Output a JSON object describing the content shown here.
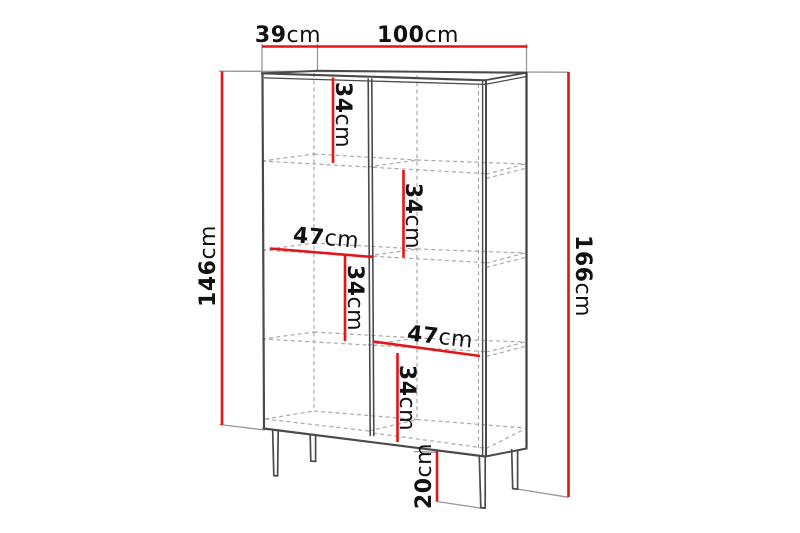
{
  "diagram": {
    "kind": "furniture-dimension-drawing",
    "subject": "two-door display cabinet with legs and interior shelves"
  },
  "colors": {
    "dimension_red": "#e61319",
    "carcass_line": "#4a4a4a",
    "back_edge_line": "#3f3f3f",
    "hidden_dashed_line": "#a8a8a8",
    "extension_line": "#979797",
    "label_text": "#111111",
    "background": "#ffffff"
  },
  "dims": {
    "depth": {
      "value": "39",
      "unit": "cm"
    },
    "width": {
      "value": "100",
      "unit": "cm"
    },
    "body_height": {
      "value": "146",
      "unit": "cm"
    },
    "total_height": {
      "value": "166",
      "unit": "cm"
    },
    "gap_top_left": {
      "value": "34",
      "unit": "cm"
    },
    "gap_upper_right": {
      "value": "34",
      "unit": "cm"
    },
    "shelf_width_left": {
      "value": "47",
      "unit": "cm"
    },
    "gap_lower_left": {
      "value": "34",
      "unit": "cm"
    },
    "shelf_width_right": {
      "value": "47",
      "unit": "cm"
    },
    "gap_bottom_right": {
      "value": "34",
      "unit": "cm"
    },
    "leg_height": {
      "value": "20",
      "unit": "cm"
    }
  }
}
